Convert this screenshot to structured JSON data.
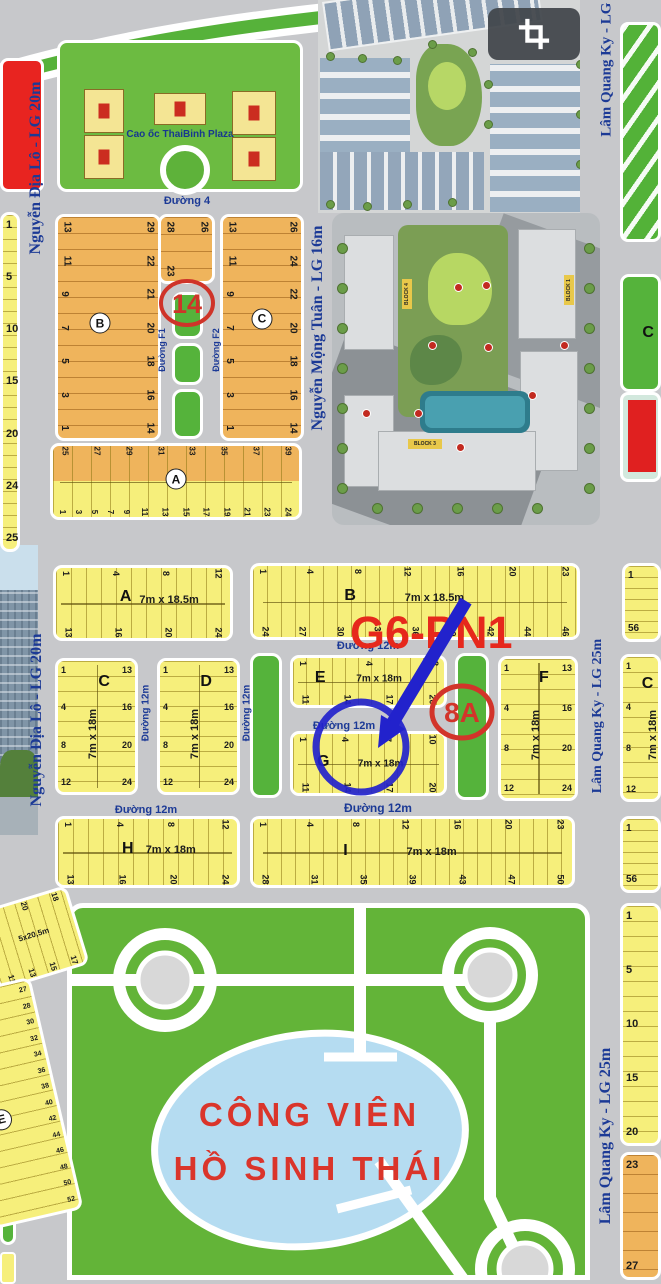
{
  "colors": {
    "road": "#c7c8cb",
    "yellow_lot": "#f6ef7b",
    "orange_lot": "#efb45c",
    "green_strip": "#55b33b",
    "park_green": "#63b438",
    "lake_blue": "#b5dcf1",
    "label_blue": "#1c3a96",
    "annotation_red": "#d2342a",
    "annotation_blue": "#2222cc"
  },
  "top": {
    "plaza_label": "Cao ốc ThaiBinh Plaza"
  },
  "aerial": {
    "tags": [
      "BLOCK 4",
      "BLOCK 1",
      "BLOCK 3"
    ]
  },
  "annotations": {
    "lot14": "14",
    "code": "G6-PN1",
    "lot8a": "8A"
  },
  "park": {
    "title_line1": "CÔNG VIÊN",
    "title_line2": "HỒ SINH THÁI"
  },
  "streets": [
    {
      "name": "duong-4",
      "text": "Đường 4"
    },
    {
      "name": "nguyen-dia-lo-upper",
      "text": "Nguyễn Địa Lô - LG 20m"
    },
    {
      "name": "nguyen-dia-lo-lower",
      "text": "Nguyễn Địa Lô - LG 20m"
    },
    {
      "name": "nguyen-mong-tuan",
      "text": "Nguyễn Mộng Tuân - LG 16m"
    },
    {
      "name": "lam-quang-ky-top",
      "text": "Lâm Quang Ky - LG 2"
    },
    {
      "name": "lam-quang-ky-mid",
      "text": "Lâm Quang Ky - LG 25m"
    },
    {
      "name": "lam-quang-ky-bottom",
      "text": "Lâm Quang Ky - LG 25m"
    },
    {
      "name": "duong-f1",
      "text": "Đường F1"
    },
    {
      "name": "duong-f2",
      "text": "Đường F2"
    },
    {
      "name": "duong-12m-v1",
      "text": "Đường 12m"
    },
    {
      "name": "duong-12m-v2",
      "text": "Đường 12m"
    },
    {
      "name": "duong-12m-b",
      "text": "Đường 12m"
    },
    {
      "name": "duong-12m-eg",
      "text": "Đường 12m"
    },
    {
      "name": "duong-12m-h",
      "text": "Đường 12m"
    },
    {
      "name": "duong-12m-i",
      "text": "Đường 12m"
    }
  ],
  "blocks": [
    {
      "name": "left-strip-upper",
      "left_nums": [
        "1",
        "5",
        "10",
        "15",
        "20",
        "24",
        "25"
      ]
    },
    {
      "name": "b-upper",
      "letter": "B",
      "letter_style": "circle",
      "left_nums": [
        "13",
        "11",
        "9",
        "7",
        "5",
        "3",
        "1"
      ],
      "right_nums": [
        "29",
        "22",
        "21",
        "20",
        "18",
        "16",
        "14"
      ]
    },
    {
      "name": "b-upper-ext",
      "left_nums": [
        "28",
        "23"
      ],
      "right_nums": [
        "26"
      ]
    },
    {
      "name": "c-upper",
      "letter": "C",
      "letter_style": "circle",
      "left_nums": [
        "13",
        "11",
        "9",
        "7",
        "5",
        "3",
        "1"
      ],
      "right_nums": [
        "26",
        "24",
        "22",
        "20",
        "18",
        "16",
        "14"
      ]
    },
    {
      "name": "a-strip",
      "letter": "A",
      "letter_style": "circle",
      "top_nums": [
        "25",
        "27",
        "29",
        "31",
        "33",
        "35",
        "37",
        "39"
      ],
      "bottom_nums": [
        "1",
        "3",
        "5",
        "7",
        "9",
        "11",
        "13",
        "15",
        "17",
        "19",
        "21",
        "23",
        "24"
      ]
    },
    {
      "name": "a-mid",
      "letter": "A",
      "dims": "7m x 18.5m",
      "top_nums": [
        "1",
        "4",
        "8",
        "12"
      ],
      "bottom_nums": [
        "13",
        "16",
        "20",
        "24"
      ]
    },
    {
      "name": "b-mid",
      "letter": "B",
      "dims": "7m x 18.5m",
      "top_nums": [
        "1",
        "4",
        "8",
        "12",
        "16",
        "20",
        "23"
      ],
      "bottom_nums": [
        "24",
        "27",
        "30",
        "33",
        "36",
        "39",
        "42",
        "44",
        "46"
      ]
    },
    {
      "name": "r-mid",
      "left_nums": [
        "1",
        "56"
      ]
    },
    {
      "name": "c-row",
      "letter": "C",
      "dims": "7m x 18m",
      "left_nums": [
        "1",
        "4",
        "8",
        "12"
      ],
      "right_nums": [
        "13",
        "16",
        "20",
        "24"
      ]
    },
    {
      "name": "d-row",
      "letter": "D",
      "dims": "7m x 18m",
      "left_nums": [
        "1",
        "4",
        "8",
        "12"
      ],
      "right_nums": [
        "13",
        "16",
        "20",
        "24"
      ]
    },
    {
      "name": "e-row",
      "letter": "E",
      "dims": "7m x 18m",
      "top_nums": [
        "1",
        "4",
        "8"
      ],
      "bottom_nums": [
        "11",
        "14",
        "17",
        "20"
      ]
    },
    {
      "name": "g-row",
      "letter": "G",
      "dims": "7m x 18m",
      "top_nums": [
        "1",
        "4",
        "7",
        "10"
      ],
      "bottom_nums": [
        "11",
        "14",
        "17",
        "20"
      ]
    },
    {
      "name": "f-row",
      "letter": "F",
      "dims": "7m x 18m",
      "left_nums": [
        "1",
        "4",
        "8",
        "12"
      ],
      "right_nums": [
        "13",
        "16",
        "20",
        "24"
      ]
    },
    {
      "name": "c-right",
      "letter": "C",
      "dims": "7m x 18m",
      "left_nums": [
        "1",
        "4",
        "8",
        "12"
      ]
    },
    {
      "name": "right-green",
      "letter": "C"
    },
    {
      "name": "h-row",
      "letter": "H",
      "dims": "7m x 18m",
      "top_nums": [
        "1",
        "4",
        "8",
        "12"
      ],
      "bottom_nums": [
        "13",
        "16",
        "20",
        "24"
      ]
    },
    {
      "name": "i-row",
      "letter": "I",
      "dims": "7m x 18m",
      "top_nums": [
        "1",
        "4",
        "8",
        "12",
        "16",
        "20",
        "23"
      ],
      "bottom_nums": [
        "28",
        "31",
        "35",
        "39",
        "43",
        "47",
        "50"
      ]
    },
    {
      "name": "r-lower",
      "left_nums": [
        "1",
        "56"
      ]
    },
    {
      "name": "rb-yellow",
      "left_nums": [
        "1",
        "5",
        "10",
        "15",
        "20"
      ]
    },
    {
      "name": "rb-orange",
      "left_nums": [
        "23",
        "27"
      ]
    },
    {
      "name": "ld-1",
      "dims": "5x20,5m",
      "top_nums": [
        "22",
        "20",
        "18"
      ],
      "bottom_nums": [
        "11",
        "13",
        "15",
        "17"
      ]
    },
    {
      "name": "ld-2",
      "letter": "E",
      "letter_style": "circle",
      "dims": "5x16,5m",
      "right_nums": [
        "27",
        "28",
        "30",
        "32",
        "34",
        "36",
        "38",
        "40",
        "42",
        "44",
        "46",
        "48",
        "50",
        "52"
      ]
    }
  ]
}
